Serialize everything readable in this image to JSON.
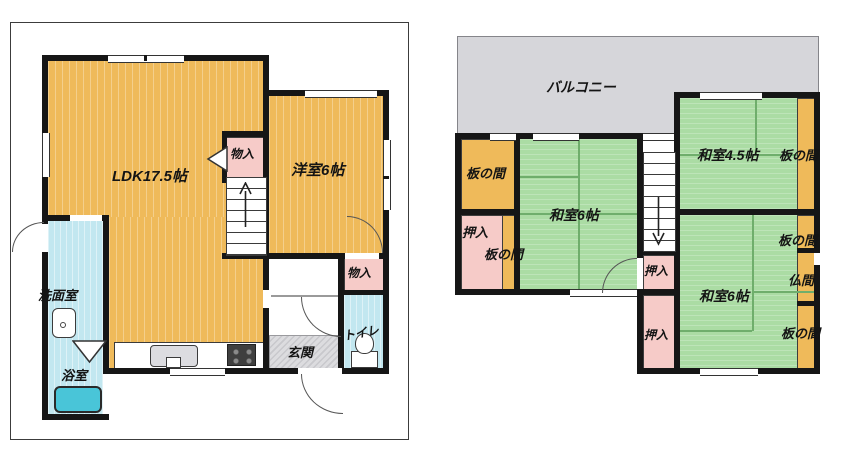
{
  "palette": {
    "wood_floor": "#EFBA5A",
    "tatami_green": "#ABDCA4",
    "closet_pink": "#F6CBC8",
    "wet_area_blue": "#C2E7F0",
    "bathtub_teal": "#49C5D8",
    "balcony_gray": "#D6D6DA",
    "entrance_gray": "#CDCDD1",
    "wall_black": "#161616"
  },
  "floor1": {
    "rooms": {
      "ldk": {
        "label": "LDK17.5帖"
      },
      "western": {
        "label": "洋室6帖"
      },
      "closet1": {
        "label": "物入"
      },
      "washroom": {
        "label": "洗面室"
      },
      "bath": {
        "label": "浴室"
      },
      "entrance": {
        "label": "玄関"
      },
      "toilet": {
        "label": "トイレ"
      },
      "closet2": {
        "label": "物入"
      }
    }
  },
  "floor2": {
    "balcony": {
      "label": "バルコニー"
    },
    "rooms": {
      "itanoma_a": {
        "label": "板の間"
      },
      "oshiire_a": {
        "label": "押入"
      },
      "itanoma_b": {
        "label": "板の間"
      },
      "washitsu6_a": {
        "label": "和室6帖"
      },
      "washitsu45": {
        "label": "和室4.5帖"
      },
      "itanoma_c": {
        "label": "板の間"
      },
      "oshiire_b": {
        "label": "押入"
      },
      "washitsu6_b": {
        "label": "和室6帖"
      },
      "itanoma_d": {
        "label": "板の間"
      },
      "butsuma": {
        "label": "仏間"
      },
      "itanoma_e": {
        "label": "板の間"
      },
      "oshiire_c": {
        "label": "押入"
      }
    }
  }
}
